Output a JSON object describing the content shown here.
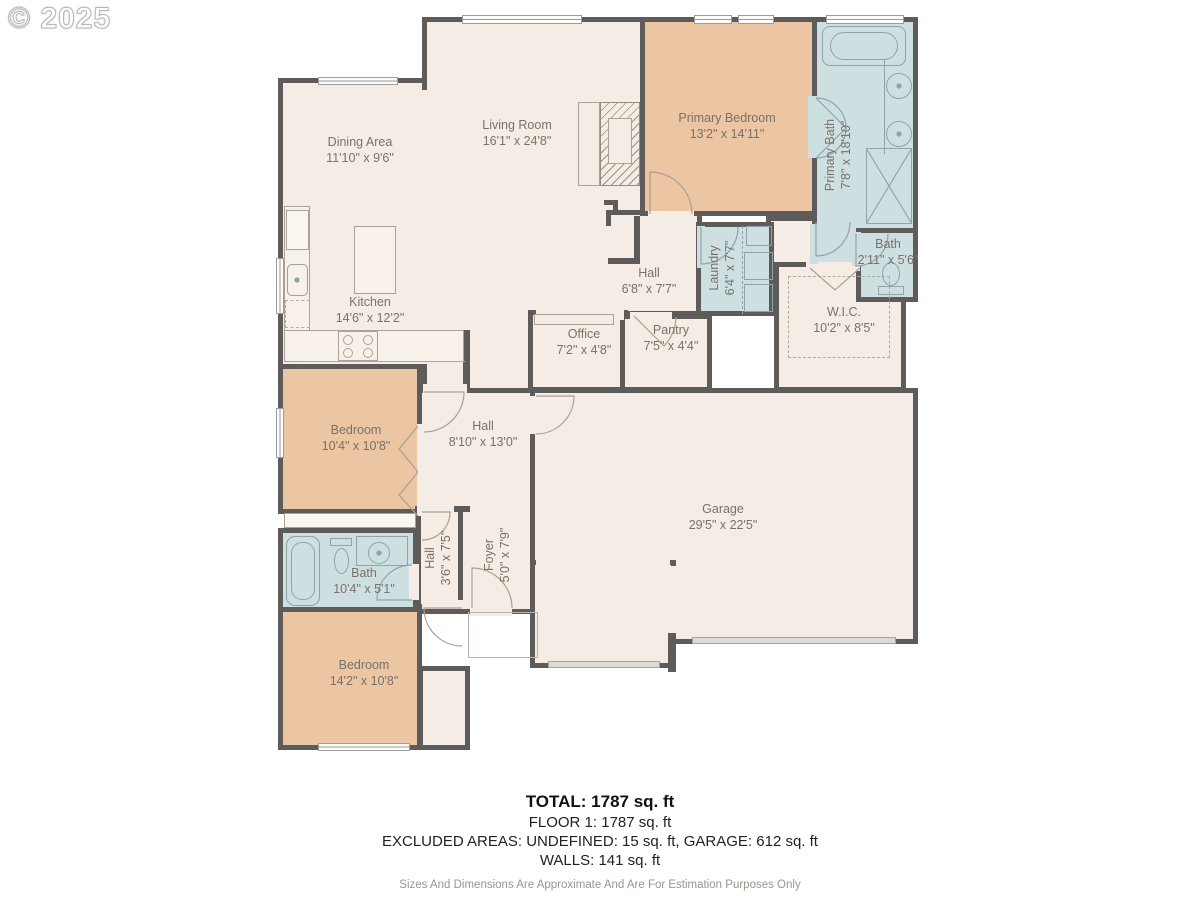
{
  "watermark": "© 2025",
  "palette": {
    "wall": "#5e5c5a",
    "floor": "#f5ede5",
    "bedroom_fill": "#ecc5a2",
    "bath_fill": "#cedfe2",
    "label_text": "#7a7168"
  },
  "rooms": {
    "dining": {
      "name": "Dining Area",
      "dims": "11'10\" x 9'6\""
    },
    "living": {
      "name": "Living Room",
      "dims": "16'1\" x 24'8\""
    },
    "primary_bedroom": {
      "name": "Primary Bedroom",
      "dims": "13'2\" x 14'11\""
    },
    "primary_bath": {
      "name": "Primary Bath",
      "dims": "7'8\" x 18'10\""
    },
    "bath_right": {
      "name": "Bath",
      "dims": "2'11\" x 5'6\""
    },
    "laundry": {
      "name": "Laundry",
      "dims": "6'4\" x 7'7\""
    },
    "hall_upper": {
      "name": "Hall",
      "dims": "6'8\" x 7'7\""
    },
    "wic": {
      "name": "W.I.C.",
      "dims": "10'2\" x 8'5\""
    },
    "office": {
      "name": "Office",
      "dims": "7'2\" x 4'8\""
    },
    "pantry": {
      "name": "Pantry",
      "dims": "7'5\" x 4'4\""
    },
    "kitchen": {
      "name": "Kitchen",
      "dims": "14'6\" x 12'2\""
    },
    "bedroom_mid": {
      "name": "Bedroom",
      "dims": "10'4\" x 10'8\""
    },
    "hall_mid": {
      "name": "Hall",
      "dims": "8'10\" x 13'0\""
    },
    "bath_mid": {
      "name": "Bath",
      "dims": "10'4\" x 5'1\""
    },
    "hall_lower": {
      "name": "Hall",
      "dims": "3'6\" x 7'5\""
    },
    "foyer": {
      "name": "Foyer",
      "dims": "5'0\" x 7'9\""
    },
    "garage": {
      "name": "Garage",
      "dims": "29'5\" x 22'5\""
    },
    "bedroom_bottom": {
      "name": "Bedroom",
      "dims": "14'2\" x 10'8\""
    }
  },
  "summary": {
    "total": "TOTAL: 1787 sq. ft",
    "floor1": "FLOOR 1: 1787 sq. ft",
    "excluded": "EXCLUDED AREAS: UNDEFINED: 15 sq. ft, GARAGE: 612 sq. ft",
    "walls": "WALLS: 141 sq. ft",
    "disclaimer": "Sizes And Dimensions Are Approximate And Are For Estimation Purposes Only"
  }
}
